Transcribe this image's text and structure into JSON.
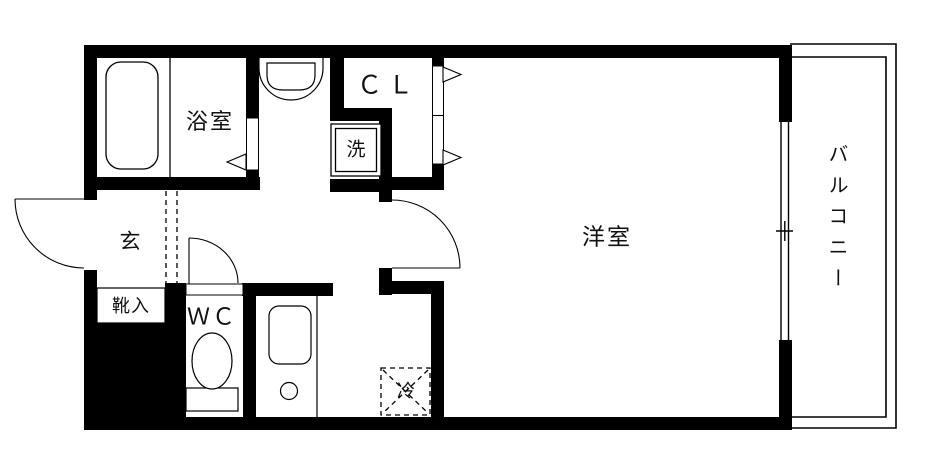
{
  "plan": {
    "type": "apartment-floor-plan",
    "colors": {
      "wall": "#000000",
      "line": "#000000",
      "background": "#ffffff",
      "floor": "#ffffff",
      "text": "#111111"
    },
    "rooms": {
      "bathroom": {
        "label": "浴室"
      },
      "closet": {
        "label": "ＣＬ"
      },
      "washer_space": {
        "label": "洗"
      },
      "entrance": {
        "label": "玄"
      },
      "shoe_cabinet": {
        "label": "靴入"
      },
      "toilet_room": {
        "label": "ＷＣ"
      },
      "refrigerator": {
        "label": "冷"
      },
      "western_room": {
        "label": "洋室"
      },
      "balcony": {
        "label": "バルコニー"
      }
    },
    "fixtures": [
      "bathtub",
      "washbasin",
      "washing-machine-space",
      "toilet",
      "kitchen-counter",
      "kitchen-sink",
      "burner-circle",
      "refrigerator-space",
      "shoe-cabinet-box",
      "entrance-swing-door",
      "wc-swing-door",
      "room-swing-door",
      "bathroom-folding-door",
      "closet-bifold-doors",
      "sliding-window",
      "entrance-step-dashed-line",
      "balcony-railing"
    ]
  }
}
